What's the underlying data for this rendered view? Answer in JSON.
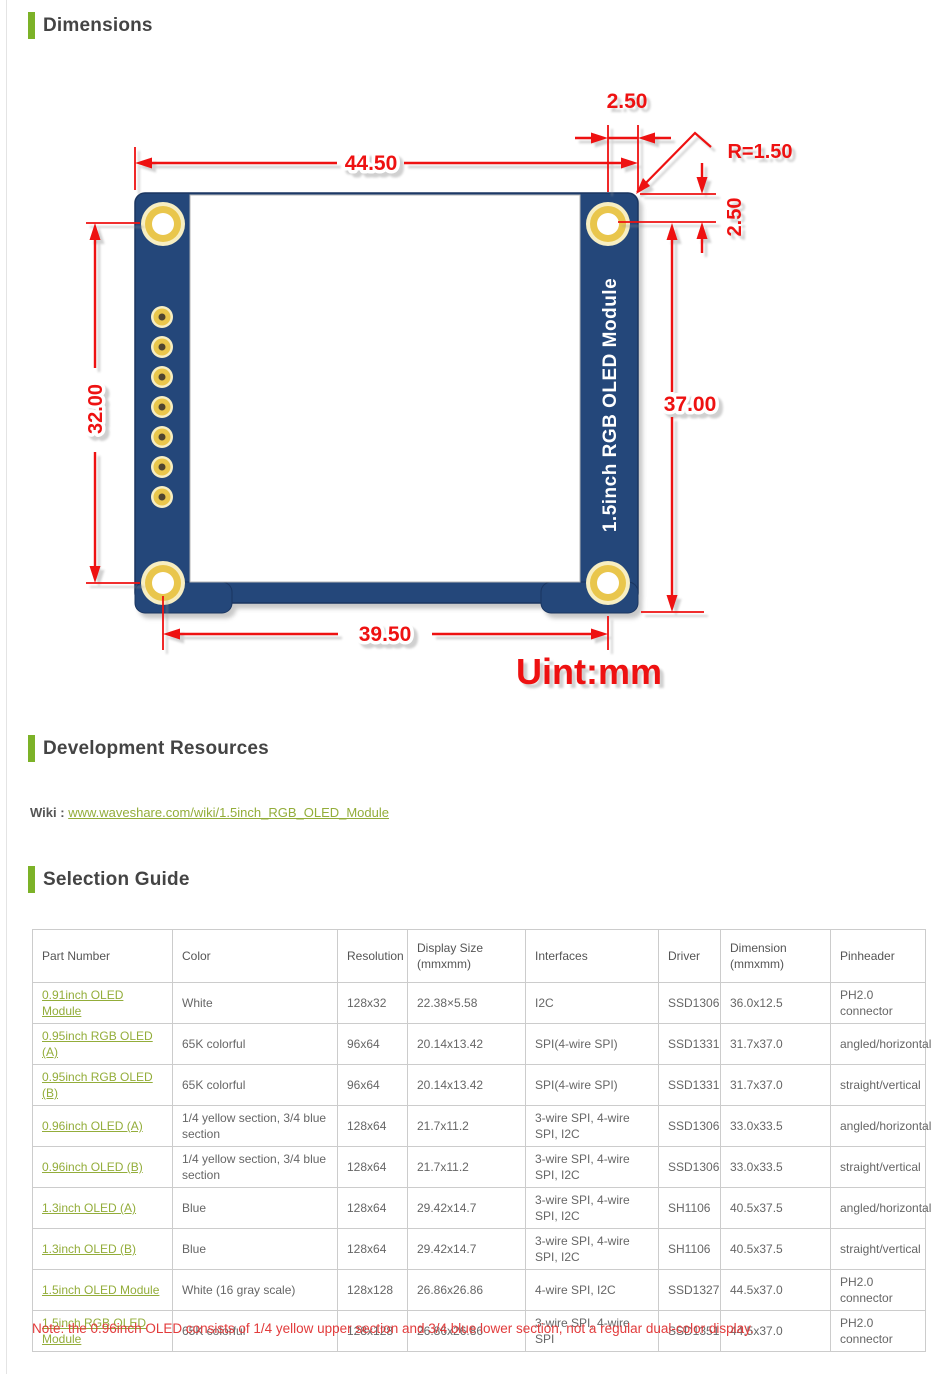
{
  "colors": {
    "green_bar": "#7cb228",
    "link_green": "#93ad3a",
    "heading_text": "#444444",
    "table_text": "#666666",
    "red": "#ee1111",
    "note_red": "#e23b3b",
    "pcb_blue": "#24477a",
    "pcb_edge": "#1a3560",
    "gold": "#e9c64c",
    "gold_rim": "#f7eec2",
    "hole_dark": "#4f4530",
    "border_gray": "#cccccc"
  },
  "sections": {
    "dimensions": {
      "heading": "Dimensions"
    },
    "development": {
      "heading": "Development Resources",
      "wiki_label": "Wiki :",
      "wiki_link": "www.waveshare.com/wiki/1.5inch_RGB_OLED_Module"
    },
    "selection": {
      "heading": "Selection Guide"
    }
  },
  "diagram": {
    "module_label": "1.5inch RGB OLED Module",
    "unit_label": "Uint:mm",
    "dims": {
      "width_top": "44.50",
      "hole_offset_top": "2.50",
      "corner_radius": "R=1.50",
      "hole_offset_right": "2.50",
      "left_height": "32.00",
      "right_height": "37.00",
      "bottom_width": "39.50"
    }
  },
  "table": {
    "headers": [
      {
        "label": "Part Number",
        "sub": ""
      },
      {
        "label": "Color",
        "sub": ""
      },
      {
        "label": "Resolution",
        "sub": ""
      },
      {
        "label": "Display Size",
        "sub": "(mmxmm)"
      },
      {
        "label": "Interfaces",
        "sub": ""
      },
      {
        "label": "Driver",
        "sub": ""
      },
      {
        "label": "Dimension",
        "sub": "(mmxmm)"
      },
      {
        "label": "Pinheader",
        "sub": ""
      }
    ],
    "rows": [
      [
        "0.91inch OLED Module",
        "White",
        "128x32",
        "22.38×5.58",
        "I2C",
        "SSD1306",
        "36.0x12.5",
        "PH2.0 connector"
      ],
      [
        "0.95inch RGB OLED (A)",
        "65K colorful",
        "96x64",
        "20.14x13.42",
        "SPI(4-wire SPI)",
        "SSD1331",
        "31.7x37.0",
        "angled/horizontal"
      ],
      [
        "0.95inch RGB OLED (B)",
        "65K colorful",
        "96x64",
        "20.14x13.42",
        "SPI(4-wire SPI)",
        "SSD1331",
        "31.7x37.0",
        "straight/vertical"
      ],
      [
        "0.96inch OLED (A)",
        "1/4 yellow section, 3/4 blue section",
        "128x64",
        "21.7x11.2",
        "3-wire SPI, 4-wire SPI, I2C",
        "SSD1306",
        "33.0x33.5",
        "angled/horizontal"
      ],
      [
        "0.96inch OLED (B)",
        "1/4 yellow section, 3/4 blue section",
        "128x64",
        "21.7x11.2",
        "3-wire SPI, 4-wire SPI, I2C",
        "SSD1306",
        "33.0x33.5",
        "straight/vertical"
      ],
      [
        "1.3inch OLED (A)",
        "Blue",
        "128x64",
        "29.42x14.7",
        "3-wire SPI, 4-wire SPI, I2C",
        "SH1106",
        "40.5x37.5",
        "angled/horizontal"
      ],
      [
        "1.3inch OLED (B)",
        "Blue",
        "128x64",
        "29.42x14.7",
        "3-wire SPI, 4-wire SPI, I2C",
        "SH1106",
        "40.5x37.5",
        "straight/vertical"
      ],
      [
        "1.5inch OLED Module",
        "White (16 gray scale)",
        "128x128",
        "26.86x26.86",
        "4-wire SPI, I2C",
        "SSD1327",
        "44.5x37.0",
        "PH2.0 connector"
      ],
      [
        "1.5inch RGB OLED Module",
        "65K colorful",
        "128x128",
        "26.86x26.86",
        "3-wire SPI, 4-wire SPI",
        "SSD1351",
        "44.5x37.0",
        "PH2.0 connector"
      ]
    ],
    "col_widths": [
      140,
      165,
      70,
      118,
      133,
      62,
      110,
      95
    ]
  },
  "note": "Note: the 0.96inch OLED consists of 1/4 yellow upper section and 3/4 blue lower section, not a regular dual-color display."
}
